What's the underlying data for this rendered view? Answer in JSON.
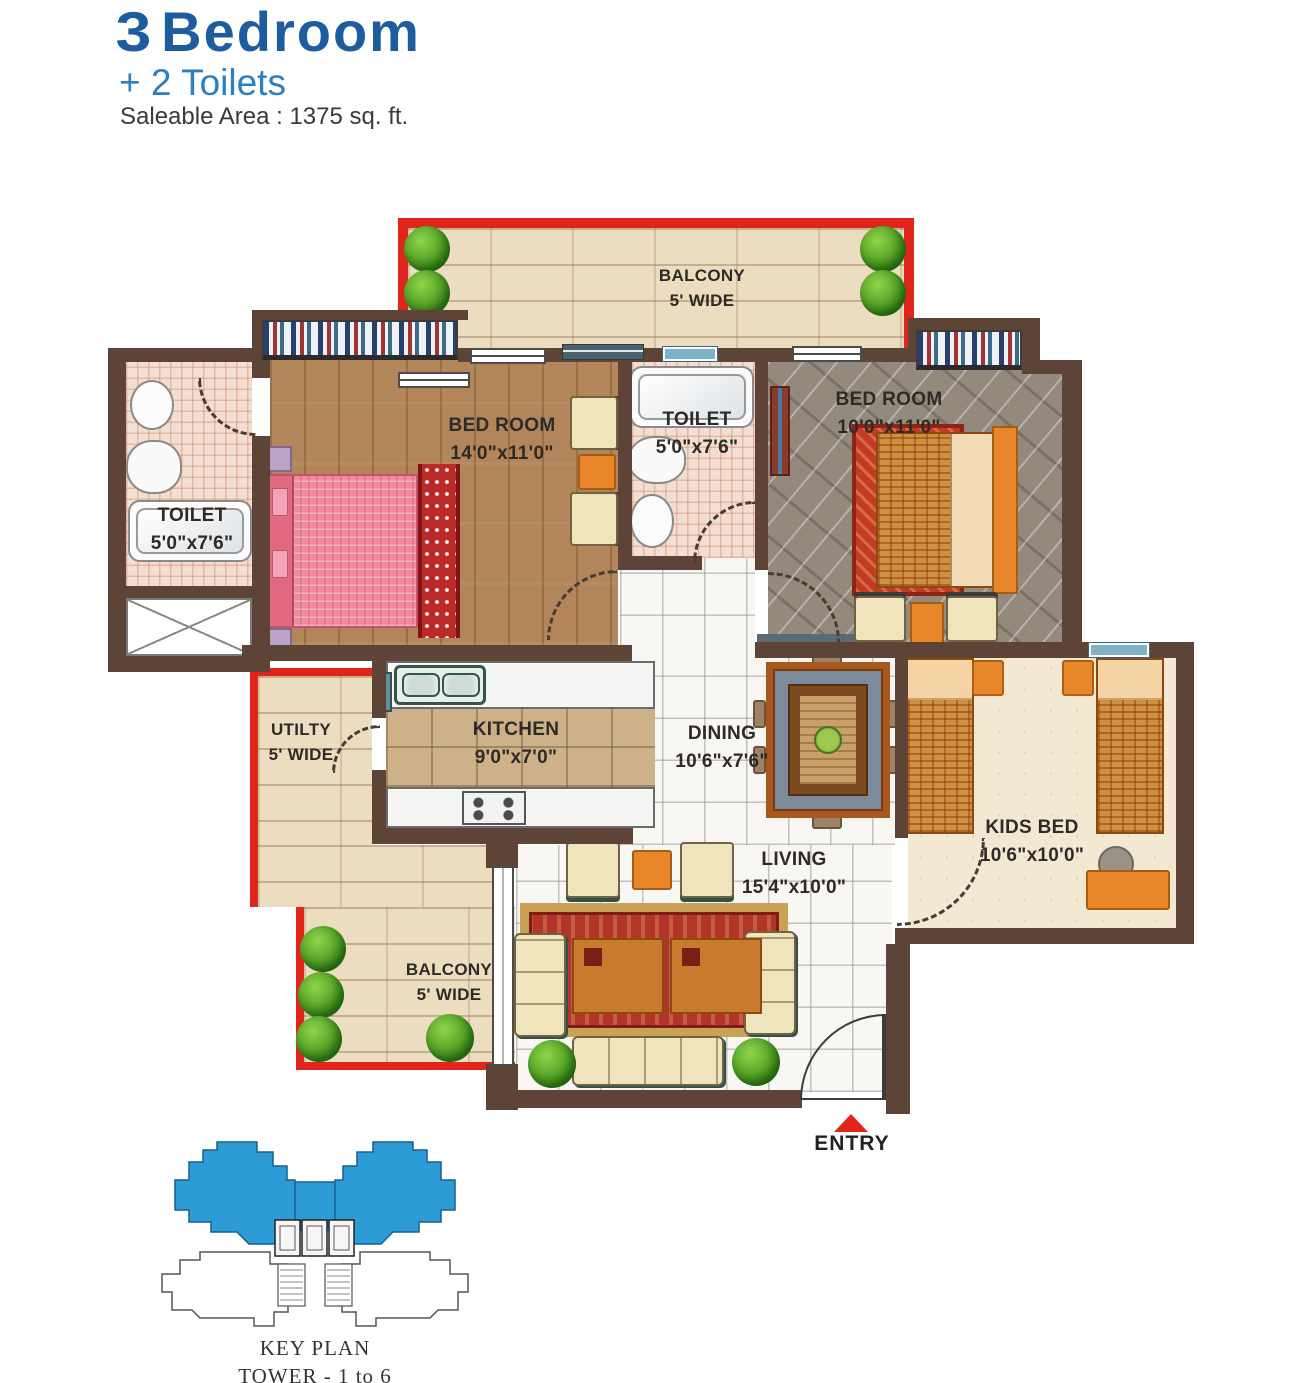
{
  "header": {
    "title_number": "3",
    "title_word": "Bedroom",
    "subtitle": "+ 2 Toilets",
    "area": "Saleable Area : 1375 sq. ft."
  },
  "rooms": {
    "balcony_top": {
      "name": "BALCONY",
      "dims": "5' WIDE"
    },
    "bedroom_master": {
      "name": "BED ROOM",
      "dims": "14'0\"x11'0\""
    },
    "toilet_mid": {
      "name": "TOILET",
      "dims": "5'0\"x7'6\""
    },
    "bedroom_second": {
      "name": "BED ROOM",
      "dims": "10'0\"x11'0\""
    },
    "toilet_left": {
      "name": "TOILET",
      "dims": "5'0\"x7'6\""
    },
    "utility": {
      "name": "UTILTY",
      "dims": "5' WIDE"
    },
    "kitchen": {
      "name": "KITCHEN",
      "dims": "9'0\"x7'0\""
    },
    "dining": {
      "name": "DINING",
      "dims": "10'6\"x7'6\""
    },
    "kids_bedroom": {
      "name": "KIDS BED",
      "dims": "10'6\"x10'0\""
    },
    "living": {
      "name": "LIVING",
      "dims": "15'4\"x10'0\""
    },
    "balcony_bottom": {
      "name": "BALCONY",
      "dims": "5' WIDE"
    }
  },
  "entry": {
    "label": "ENTRY"
  },
  "key_plan": {
    "title": "KEY PLAN",
    "subtitle": "TOWER - 1 to 6 & 8"
  },
  "colors": {
    "title_blue": "#1d5c9e",
    "subtitle_blue": "#2d7fc0",
    "wall_brown": "#5e4337",
    "balcony_red": "#e0251b",
    "keyplan_blue": "#2d9bd6"
  }
}
